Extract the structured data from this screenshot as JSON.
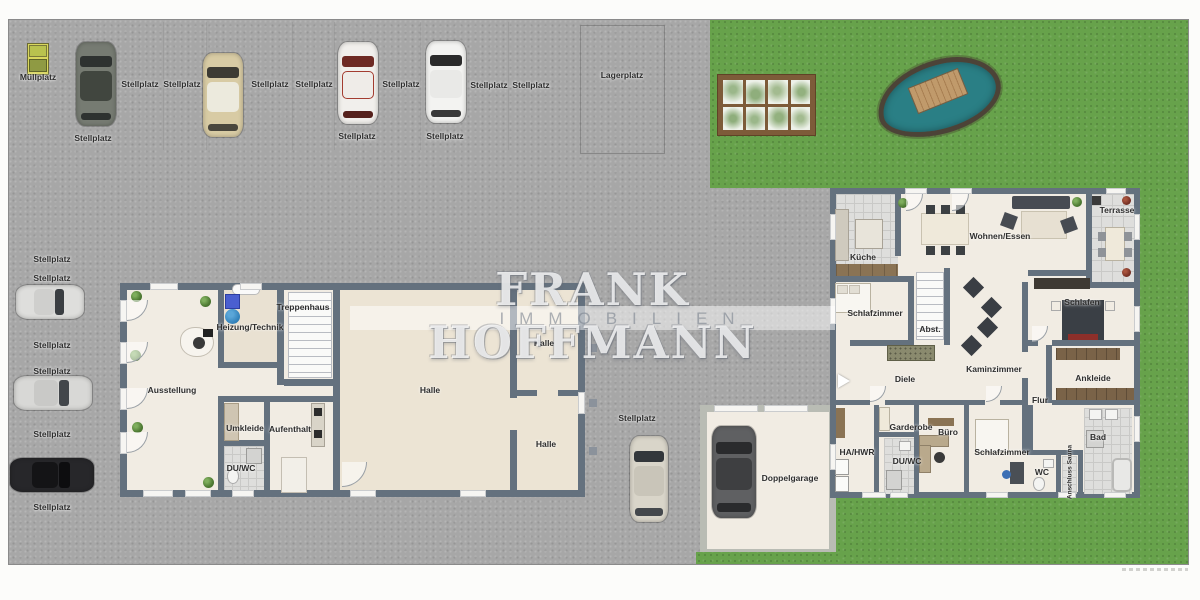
{
  "brand": {
    "line1": "FRANK HOFFMANN",
    "line2": "IMMOBILIEN"
  },
  "site_labels": {
    "muellplatz": "Müllplatz",
    "stellplatz": "Stellplatz",
    "lagerplatz": "Lagerplatz"
  },
  "hall": {
    "ausstellung": "Ausstellung",
    "heizung_technik": "Heizung/Technik",
    "treppenhaus": "Treppenhaus",
    "halle": "Halle",
    "umkleide": "Umkleide",
    "aufenthalt": "Aufenthalt",
    "du_wc": "DU/WC"
  },
  "house": {
    "kueche": "Küche",
    "wohnen_essen": "Wohnen/Essen",
    "terrasse": "Terrasse",
    "schlafzimmer": "Schlafzimmer",
    "abst": "Abst.",
    "schlafen": "Schlafen",
    "kaminzimmer": "Kaminzimmer",
    "diele": "Diele",
    "ankleide": "Ankleide",
    "flur": "Flur",
    "ha_hwr": "HA/HWR",
    "garderobe": "Garderobe",
    "buero": "Büro",
    "du_wc": "DU/WC",
    "schlafzimmer2": "Schlafzimmer",
    "wc": "WC",
    "anschluss_sauna": "Anschluss Sauna",
    "bad": "Bad"
  },
  "garage": {
    "doppelgarage": "Doppelgarage"
  },
  "colors": {
    "wall": "#64717e",
    "pavement": "#a7a7a7",
    "lawn": "#67a24b",
    "floor": "#f1ece3",
    "halle_floor": "#ece4d4",
    "pond": "#2a7f85"
  }
}
